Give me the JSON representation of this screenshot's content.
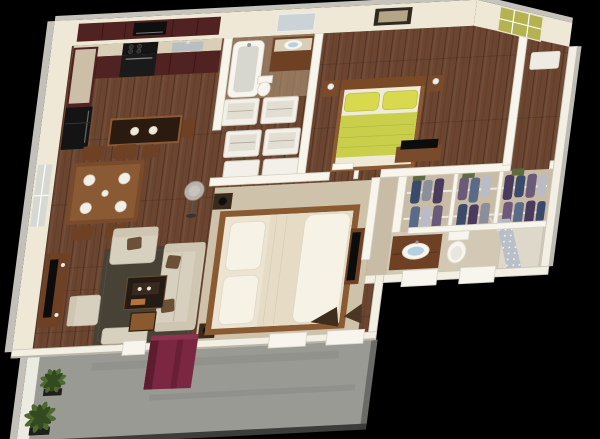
{
  "image": {
    "width": 600,
    "height": 439,
    "type": "3d-floorplan-render",
    "background": "#000000",
    "description": "Isometric 3D dollhouse render of an apartment floor plan with balcony, viewed from above on a black background"
  },
  "palette": {
    "bg": "#000000",
    "wallFace": "#efe8d6",
    "wallFaceLight": "#f4efe3",
    "wallCap": "#c6c3ba",
    "wallBand": "#f8f5ec",
    "wallBandEdge": "#d6d2c4",
    "woodFloor": "#6b4530",
    "woodLine": "#45291a",
    "carpet": "#cfc2ab",
    "tanFloor": "#c9bca6",
    "balconyFloor": "#9a9a95",
    "balconyRim": "#3c3c3a",
    "parapet": "#ecebe2",
    "cabinet": "#512222",
    "counter": "#d9cfb6",
    "appliance": "#141414",
    "islandTop": "#2a1a10",
    "woodFurniture": "#7a4b2b",
    "woodFurnitureDark": "#6e4124",
    "sofa": "#d8d0bf",
    "sofaShade": "#cfc6b2",
    "pillowBrown": "#6b5138",
    "rug": "#474136",
    "bedFrame": "#8a5a32",
    "bedding": "#ece3d0",
    "beddingBright": "#f6f2e6",
    "beddingYellow": "#c9cf4a",
    "pillowYellow": "#d8d94f",
    "towel": "#7b2742",
    "towelShade": "#5e1c31",
    "plant": "#4c6a2f",
    "plantDark": "#33491f",
    "door": "#b5b252",
    "clothes1": "#3a4a6b",
    "clothes2": "#6b5a7a",
    "clothes3": "#8a8f9a",
    "clothes4": "#4a3a5e",
    "clothes5": "#b9bcc6",
    "clothes6": "#5a6b8a",
    "curtain": "#b6bec8",
    "fixture": "#f7f5ee",
    "fixtureEdge": "#d8d5c8",
    "sinkBlue": "#a8c8dc",
    "tv": "#0c0c0c",
    "lamp": "#b8b3aa",
    "mirror": "#ccd3d6",
    "pictureFrame": "#2f2a20",
    "pictureInner": "#b3a585",
    "mat": "#eeece2"
  },
  "scene": {
    "rooms": [
      {
        "name": "kitchen",
        "features": [
          "L-shaped maroon cabinets",
          "black oven and cooktop",
          "microwave",
          "refrigerator",
          "sink",
          "island with bar stools"
        ]
      },
      {
        "name": "dining-area",
        "features": [
          "wood dining table",
          "four white place settings",
          "four chairs"
        ]
      },
      {
        "name": "living-room",
        "features": [
          "beige sofa",
          "armchair",
          "ottoman bench",
          "dark area rug",
          "coffee table with tray",
          "media console with tv",
          "gray floor lamp"
        ]
      },
      {
        "name": "laundry-utility",
        "features": [
          "white washer-dryer storage cubes"
        ]
      },
      {
        "name": "bathroom-main",
        "features": [
          "bathtub",
          "wood vanity with mirror",
          "toilet"
        ]
      },
      {
        "name": "bedroom-2",
        "features": [
          "double bed with yellow-green bedding",
          "wood headboard",
          "two nightstands with lamps",
          "framed wall picture",
          "dresser with tv"
        ]
      },
      {
        "name": "master-bedroom",
        "features": [
          "large bed with cream bedding",
          "white pillows",
          "nightstands with black lamps",
          "dresser with tv"
        ]
      },
      {
        "name": "walk-in-closet",
        "features": [
          "two rails of hanging clothes",
          "white shelf dividers",
          "green storage baskets"
        ]
      },
      {
        "name": "ensuite-bathroom",
        "features": [
          "wood vanity with oval sink",
          "toilet",
          "shower with patterned gray curtain"
        ]
      },
      {
        "name": "entry",
        "features": [
          "olive-yellow french entry door",
          "white floor mat"
        ]
      },
      {
        "name": "balcony",
        "features": [
          "concrete floor",
          "white parapet walls",
          "two potted green plants",
          "burgundy towel draped over railing"
        ]
      }
    ]
  }
}
